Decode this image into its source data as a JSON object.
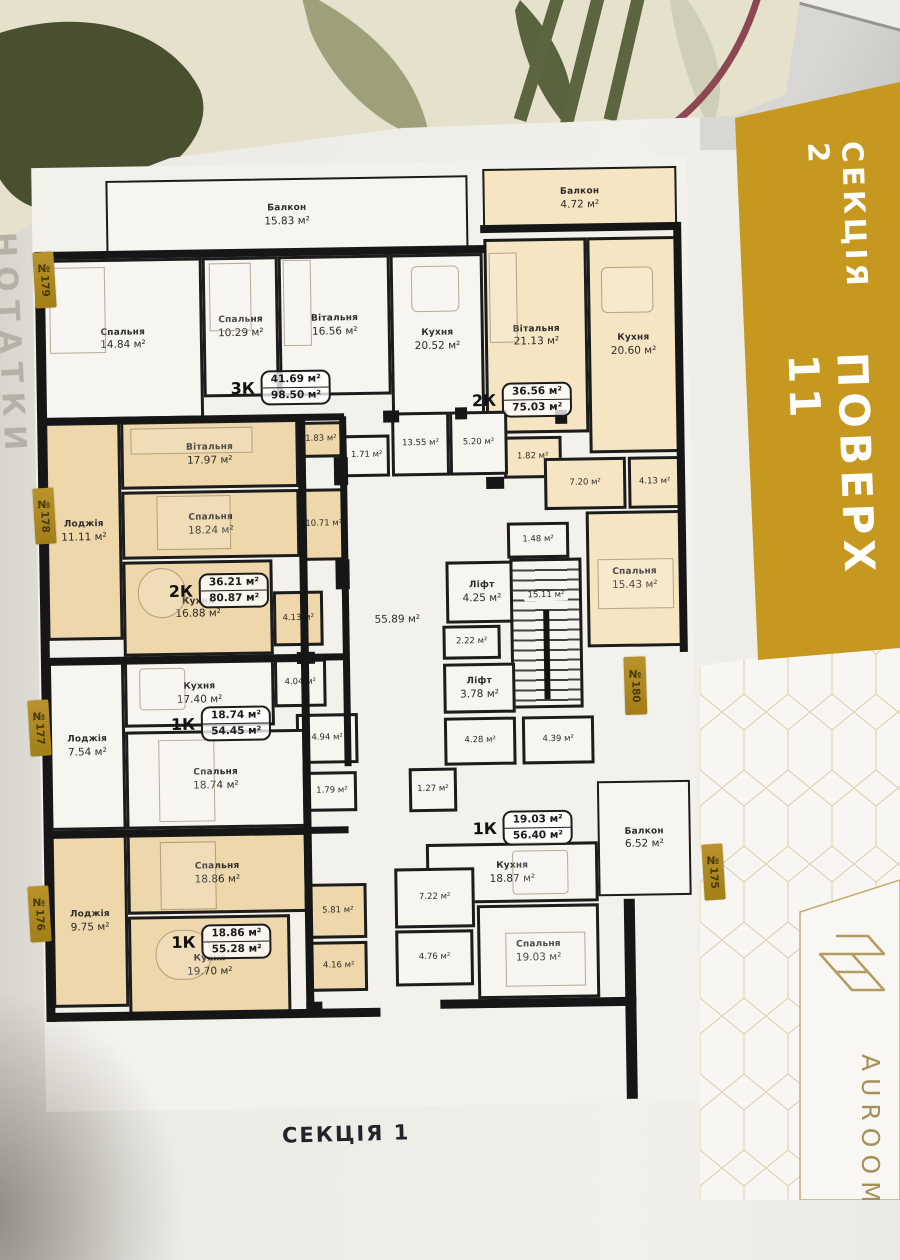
{
  "photo": {
    "footer_label": "СЕКЦІЯ 1",
    "margin_note": "НОТАТКИ",
    "brand": "AUROOM"
  },
  "banner": {
    "section": "СЕКЦІЯ 2",
    "floor": "ПОВЕРХ 11",
    "color": "#c6981f"
  },
  "units": [
    "№179",
    "№178",
    "№177",
    "№176",
    "№180",
    "№175"
  ],
  "colors": {
    "accent_gold": "#c6981f",
    "tag_gold": "#ab851c",
    "room_beige": "#eed7ab",
    "room_beige_light": "#f5e5c3",
    "room_white": "#f7f5f0",
    "wall": "#1c1c1c"
  },
  "plan": {
    "apartments": [
      {
        "type": "3К",
        "area_live": "41.69 м²",
        "area_total": "98.50 м²",
        "rooms": [
          {
            "name": "Балкон",
            "area": "15.83 м²"
          },
          {
            "name": "Спальня",
            "area": "14.84 м²"
          },
          {
            "name": "Спальня",
            "area": "10.29 м²"
          },
          {
            "name": "Вітальня",
            "area": "16.56 м²"
          },
          {
            "name": "Кухня",
            "area": "20.52 м²"
          }
        ]
      },
      {
        "type": "2К",
        "area_live": "36.56 м²",
        "area_total": "75.03 м²",
        "rooms": [
          {
            "name": "Балкон",
            "area": "4.72 м²"
          },
          {
            "name": "Вітальня",
            "area": "21.13 м²"
          },
          {
            "name": "Кухня",
            "area": "20.60 м²"
          },
          {
            "name": "",
            "area": "1.82 м²"
          },
          {
            "name": "",
            "area": "7.20 м²"
          },
          {
            "name": "",
            "area": "4.13 м²"
          },
          {
            "name": "Спальня",
            "area": "15.43 м²"
          }
        ]
      },
      {
        "type": "2К",
        "area_live": "36.21 м²",
        "area_total": "80.87 м²",
        "rooms": [
          {
            "name": "Лоджія",
            "area": "11.11 м²"
          },
          {
            "name": "Вітальня",
            "area": "17.97 м²"
          },
          {
            "name": "Спальня",
            "area": "18.24 м²"
          },
          {
            "name": "",
            "area": "1.83 м²"
          },
          {
            "name": "",
            "area": "10.71 м²"
          },
          {
            "name": "Кухня",
            "area": "16.88 м²"
          },
          {
            "name": "",
            "area": "4.13 м²"
          }
        ]
      },
      {
        "type": "1К",
        "area_live": "18.74 м²",
        "area_total": "54.45 м²",
        "rooms": [
          {
            "name": "Лоджія",
            "area": "7.54 м²"
          },
          {
            "name": "Кухня",
            "area": "17.40 м²"
          },
          {
            "name": "",
            "area": "4.04 м²"
          },
          {
            "name": "",
            "area": "4.94 м²"
          },
          {
            "name": "Спальня",
            "area": "18.74 м²"
          },
          {
            "name": "",
            "area": "1.79 м²"
          }
        ]
      },
      {
        "type": "1К",
        "area_live": "18.86 м²",
        "area_total": "55.28 м²",
        "rooms": [
          {
            "name": "Лоджія",
            "area": "9.75 м²"
          },
          {
            "name": "Спальня",
            "area": "18.86 м²"
          },
          {
            "name": "",
            "area": "5.81 м²"
          },
          {
            "name": "Кухня",
            "area": "19.70 м²"
          },
          {
            "name": "",
            "area": "4.16 м²"
          }
        ]
      },
      {
        "type": "1К",
        "area_live": "19.03 м²",
        "area_total": "56.40 м²",
        "rooms": [
          {
            "name": "Кухня",
            "area": "18.87 м²"
          },
          {
            "name": "",
            "area": "7.22 м²"
          },
          {
            "name": "Спальня",
            "area": "19.03 м²"
          },
          {
            "name": "",
            "area": "4.76 м²"
          },
          {
            "name": "Балкон",
            "area": "6.52 м²"
          }
        ]
      }
    ],
    "common": [
      {
        "name": "",
        "area": "13.55 м²"
      },
      {
        "name": "",
        "area": "5.20 м²"
      },
      {
        "name": "",
        "area": "1.71 м²"
      },
      {
        "name": "",
        "area": "1.48 м²"
      },
      {
        "name": "",
        "area": "55.89 м²"
      },
      {
        "name": "Ліфт",
        "area": "4.25 м²"
      },
      {
        "name": "",
        "area": "15.11 м²"
      },
      {
        "name": "",
        "area": "2.22 м²"
      },
      {
        "name": "Ліфт",
        "area": "3.78 м²"
      },
      {
        "name": "",
        "area": "4.28 м²"
      },
      {
        "name": "",
        "area": "4.39 м²"
      },
      {
        "name": "",
        "area": "1.27 м²"
      }
    ]
  }
}
